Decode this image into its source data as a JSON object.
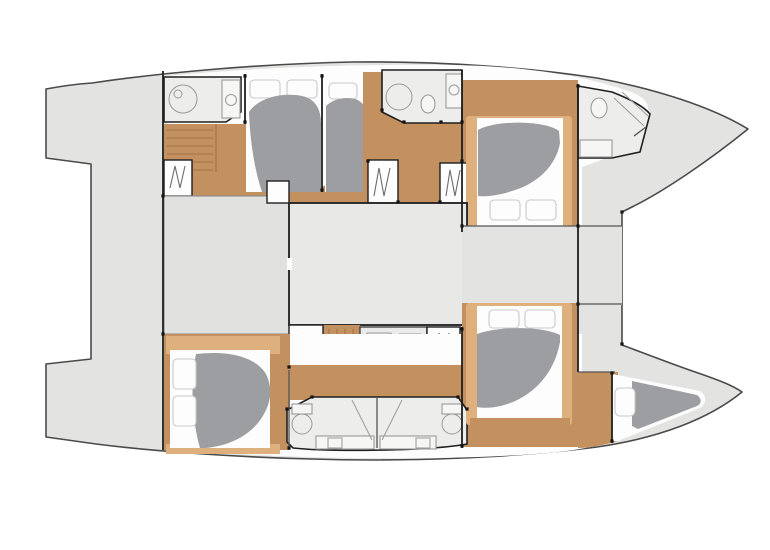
{
  "page": {
    "background": "#ffffff"
  },
  "diagram": {
    "kind": "yacht floor plan",
    "vessel": "sailing catamaran",
    "view": "overhead interior layout, bow to the right",
    "berth_count": "6",
    "bathroom_count": "5"
  },
  "colors": {
    "background": "#ffffff",
    "deck": "#e3e3e2",
    "hullOutline": "#4a4a4a",
    "wall": "#1f1f1f",
    "blockLine": "#8a8a8a",
    "roomLine": "#9a9a9a",
    "wood": "#c3905f",
    "woodLight": "#ddb07e",
    "woodLine": "#a0744a",
    "room": "#ededec",
    "saloonLeft": "#e1e1e0",
    "saloonMain": "#e8e8e7",
    "bed": "#9d9ea1",
    "linen": "#fdfdfd",
    "pillowLine": "#c9c9c9"
  },
  "features": {
    "canvas": "Catamaran interior layout plan",
    "hull": "Catamaran hull and deck silhouette",
    "cockpit": "Aft cockpit with twin transom steps",
    "saloon": "Central saloon",
    "galley": "Galley unit",
    "portHull": "Port hull (top)",
    "stbdHull": "Starboard hull (bottom)",
    "portAftHead": "Port aft bathroom",
    "portAftBerths": "Port aft berths",
    "portMidHead": "Port midship bathroom",
    "portFwdCabin": "Port forward double cabin",
    "portFwdHead": "Port forward bathroom",
    "stbdAftCabin": "Starboard aft double cabin",
    "stbdAftHeads": "Starboard twin aft bathrooms",
    "stbdFwdCabin": "Starboard forward double cabin",
    "forepeak": "Forepeak berth",
    "wardrobe": "Hanging locker",
    "stairs": "Companionway steps",
    "crossbeam": "Forward crossbeam deck"
  }
}
